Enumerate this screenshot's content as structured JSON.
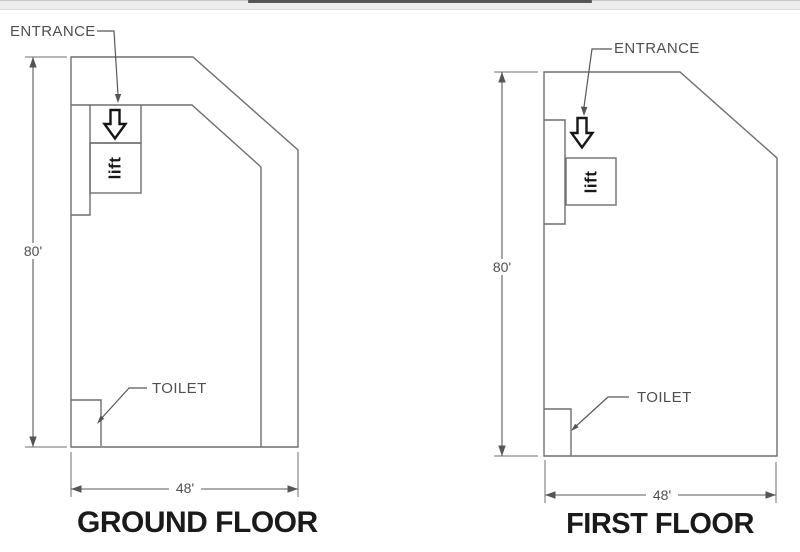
{
  "colors": {
    "background": "#ffffff",
    "plan_line": "#6f6f6f",
    "leader_line": "#585858",
    "label_text": "#4f4f4f",
    "title_text": "#1a1a1a",
    "icon_ink": "#161616",
    "top_bar": "#ececec",
    "top_bar_dark_segment": "#3d3d3d"
  },
  "floors": [
    {
      "id": "ground",
      "title": "GROUND FLOOR",
      "entrance_label": "ENTRANCE",
      "toilet_label": "TOILET",
      "lift_label": "lift",
      "height_dimension": "80'",
      "width_dimension": "48'"
    },
    {
      "id": "first",
      "title": "FIRST FLOOR",
      "entrance_label": "ENTRANCE",
      "toilet_label": "TOILET",
      "lift_label": "lift",
      "height_dimension": "80'",
      "width_dimension": "48'"
    }
  ]
}
